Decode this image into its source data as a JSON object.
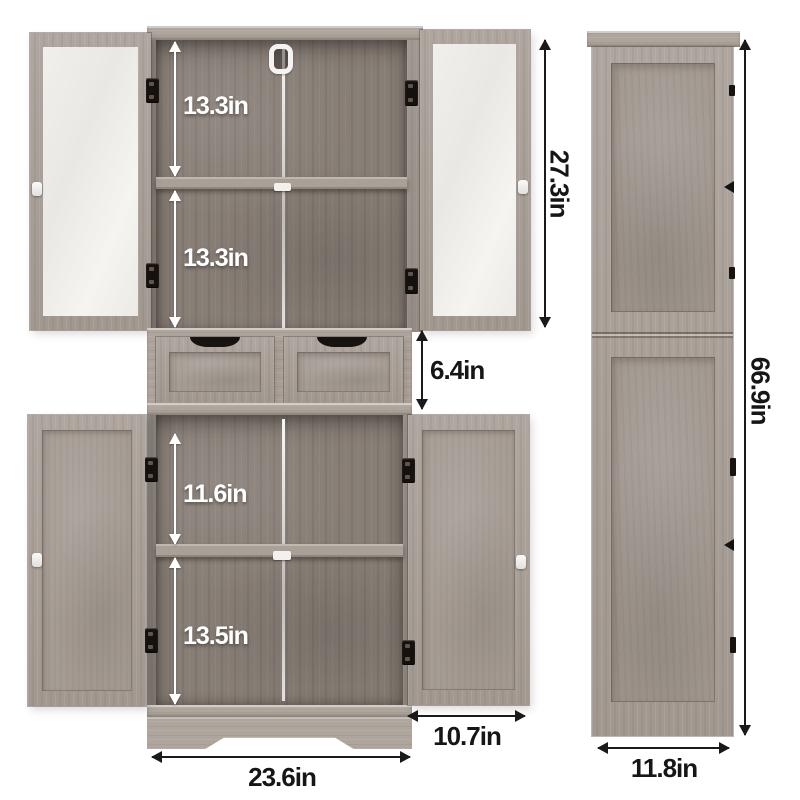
{
  "annotations": {
    "front": {
      "upper_shelf_space_1": "13.3in",
      "upper_shelf_space_2": "13.3in",
      "upper_cabinet_height": "27.3in",
      "drawer_height": "6.4in",
      "lower_shelf_space_1": "11.6in",
      "lower_shelf_space_2": "13.5in",
      "door_width": "10.7in",
      "cabinet_width": "23.6in"
    },
    "side": {
      "overall_height": "66.9in",
      "cabinet_depth": "11.8in"
    }
  },
  "colors": {
    "background": "#ffffff",
    "wood_exterior": "#a9a098",
    "wood_interior": "#877e76",
    "glass": "#efeeec",
    "dimension_dark": "#161616",
    "dimension_light": "#ffffff",
    "hardware": "#17110d"
  }
}
